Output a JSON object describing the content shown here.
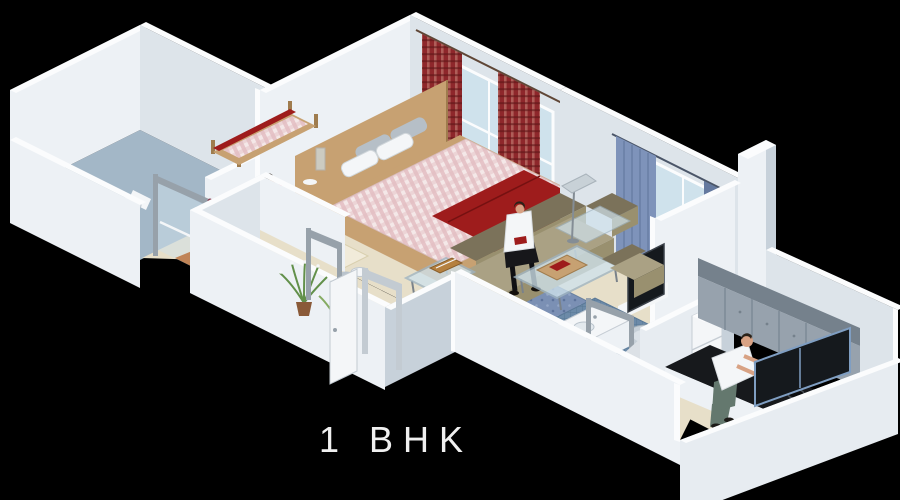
{
  "scene": {
    "caption": "1 BHK",
    "description": "3D isometric cut-away floor plan render of a 1 BHK apartment on a black background"
  },
  "rooms": [
    {
      "id": "bathroom-1",
      "label": "bathroom with toilet and glass door"
    },
    {
      "id": "bedroom",
      "label": "bedroom with double bed, daybed, red curtains, woman with children"
    },
    {
      "id": "entrance-porch",
      "label": "entrance balcony with open door and green plants"
    },
    {
      "id": "living-room",
      "label": "living room with L-shaped sofa, man, glass tables, lamp, TV, blue curtains"
    },
    {
      "id": "bathroom-2",
      "label": "bathroom with washbasin and tub, blue mosaic floor"
    },
    {
      "id": "kitchen",
      "label": "kitchen with man cooking at black hob counter, gray cabinets, fridge"
    }
  ],
  "colors": {
    "bg": "#000000",
    "wallLit": "#edf1f5",
    "wallLit2": "#e7ecf1",
    "wallMid": "#dde4ea",
    "wallShade": "#c7d1da",
    "wallTop": "#fbfcfd",
    "floor": "#e7dfc9",
    "carpet": "#f1ebda",
    "terracotta": "#c08457",
    "wood": "#c7a172",
    "woodDark": "#9f7c4e",
    "tileBath": "#a3b7c7",
    "red": "#9e1c1c",
    "redDark": "#751111",
    "curtainRed": "#8e272b",
    "curtainBlue": "#7e93ba",
    "curtainBlueDk": "#64799f",
    "glass": "#cfe2ec",
    "metal": "#97a1aa",
    "olive": "#99906f",
    "oliveDark": "#7b725a",
    "oliveLight": "#aaa184",
    "rugBlue": "#7b90b4",
    "cab": "#97a2ad",
    "cabLight": "#b7c0c9",
    "cabDark": "#75818c",
    "counter": "#17191c",
    "darkGlass": "#15191d",
    "whiteSoft": "#f4f6f8",
    "skin": "#d8a284",
    "hair": "#2b2219",
    "pink": "#ee9db1",
    "denim": "#64786e",
    "green": "#62904a",
    "pot": "#8a5a38",
    "kitchenFloor": "#dce1e6",
    "captionColor": "#f0f0f0"
  }
}
